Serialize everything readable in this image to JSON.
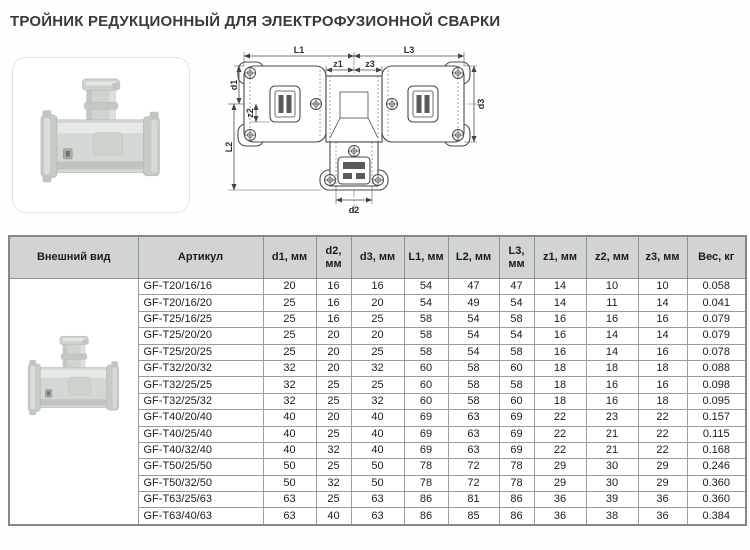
{
  "page_title": "ТРОЙНИК РЕДУКЦИОННЫЙ  ДЛЯ ЭЛЕКТРОФУЗИОННОЙ СВАРКИ",
  "colors": {
    "table_header_bg": "#d2d3d4",
    "table_border": "#8d9295",
    "title_text": "#3a3a3a",
    "photo_fill": "#d4d8d4"
  },
  "drawing": {
    "labels": {
      "L1": "L1",
      "L3": "L3",
      "z1": "z1",
      "z3": "z3",
      "d1": "d1",
      "z2": "z2",
      "d3": "d3",
      "L2": "L2",
      "d2": "d2"
    }
  },
  "table": {
    "headers": [
      "Внешний вид",
      "Артикул",
      "d1, мм",
      "d2, мм",
      "d3, мм",
      "L1, мм",
      "L2, мм",
      "L3, мм",
      "z1, мм",
      "z2, мм",
      "z3, мм",
      "Вес, кг"
    ],
    "rows": [
      [
        "GF-T20/16/16",
        "20",
        "16",
        "16",
        "54",
        "47",
        "47",
        "14",
        "10",
        "10",
        "0.058"
      ],
      [
        "GF-T20/16/20",
        "25",
        "16",
        "20",
        "54",
        "49",
        "54",
        "14",
        "11",
        "14",
        "0.041"
      ],
      [
        "GF-T25/16/25",
        "25",
        "16",
        "25",
        "58",
        "54",
        "58",
        "16",
        "16",
        "16",
        "0.079"
      ],
      [
        "GF-T25/20/20",
        "25",
        "20",
        "20",
        "58",
        "54",
        "54",
        "16",
        "14",
        "14",
        "0.079"
      ],
      [
        "GF-T25/20/25",
        "25",
        "20",
        "25",
        "58",
        "54",
        "58",
        "16",
        "14",
        "16",
        "0.078"
      ],
      [
        "GF-T32/20/32",
        "32",
        "20",
        "32",
        "60",
        "58",
        "60",
        "18",
        "18",
        "18",
        "0.088"
      ],
      [
        "GF-T32/25/25",
        "32",
        "25",
        "25",
        "60",
        "58",
        "58",
        "18",
        "16",
        "16",
        "0.098"
      ],
      [
        "GF-T32/25/32",
        "32",
        "25",
        "32",
        "60",
        "58",
        "60",
        "18",
        "16",
        "18",
        "0.095"
      ],
      [
        "GF-T40/20/40",
        "40",
        "20",
        "40",
        "69",
        "63",
        "69",
        "22",
        "23",
        "22",
        "0.157"
      ],
      [
        "GF-T40/25/40",
        "40",
        "25",
        "40",
        "69",
        "63",
        "69",
        "22",
        "21",
        "22",
        "0.115"
      ],
      [
        "GF-T40/32/40",
        "40",
        "32",
        "40",
        "69",
        "63",
        "69",
        "22",
        "21",
        "22",
        "0.168"
      ],
      [
        "GF-T50/25/50",
        "50",
        "25",
        "50",
        "78",
        "72",
        "78",
        "29",
        "30",
        "29",
        "0.246"
      ],
      [
        "GF-T50/32/50",
        "50",
        "32",
        "50",
        "78",
        "72",
        "78",
        "29",
        "30",
        "29",
        "0.360"
      ],
      [
        "GF-T63/25/63",
        "63",
        "25",
        "63",
        "86",
        "81",
        "86",
        "36",
        "39",
        "36",
        "0.360"
      ],
      [
        "GF-T63/40/63",
        "63",
        "40",
        "63",
        "86",
        "85",
        "86",
        "36",
        "38",
        "36",
        "0.384"
      ]
    ]
  }
}
